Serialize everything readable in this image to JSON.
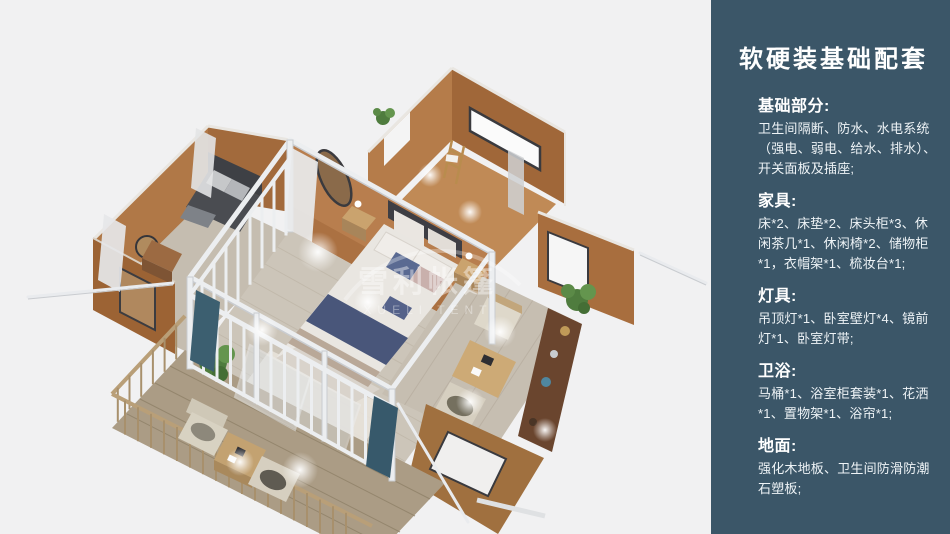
{
  "sidebar": {
    "title": "软硬装基础配套",
    "sections": [
      {
        "heading": "基础部分:",
        "body": "卫生间隔断、防水、水电系统（强电、弱电、给水、排水）、开关面板及插座;"
      },
      {
        "heading": "家具:",
        "body": "床*2、床垫*2、床头柜*3、休闲茶几*1、休闲椅*2、储物柜*1，衣帽架*1、梳妆台*1;"
      },
      {
        "heading": "灯具:",
        "body": "吊顶灯*1、卧室壁灯*4、镜前灯*1、卧室灯带;"
      },
      {
        "heading": "卫浴:",
        "body": "马桶*1、浴室柜套装*1、花洒*1、置物架*1、浴帘*1;"
      },
      {
        "heading": "地面:",
        "body": "强化木地板、卫生间防滑防潮石塑板;"
      }
    ]
  },
  "render": {
    "watermark_cn": "雪利帐篷",
    "watermark_en": "XUELI TENT"
  },
  "colors": {
    "sidebar_bg": "#3b5668",
    "canvas_bg": "#f1f1f2",
    "wall_tan": "#ad7544",
    "floor_wood": "#ccc5b9",
    "deck_wood": "#ab9c85",
    "frame_white": "#eceef0",
    "bedding_navy": "#49567a",
    "plant_green": "#4f7c3e",
    "curtain_teal": "#3c5f70"
  }
}
